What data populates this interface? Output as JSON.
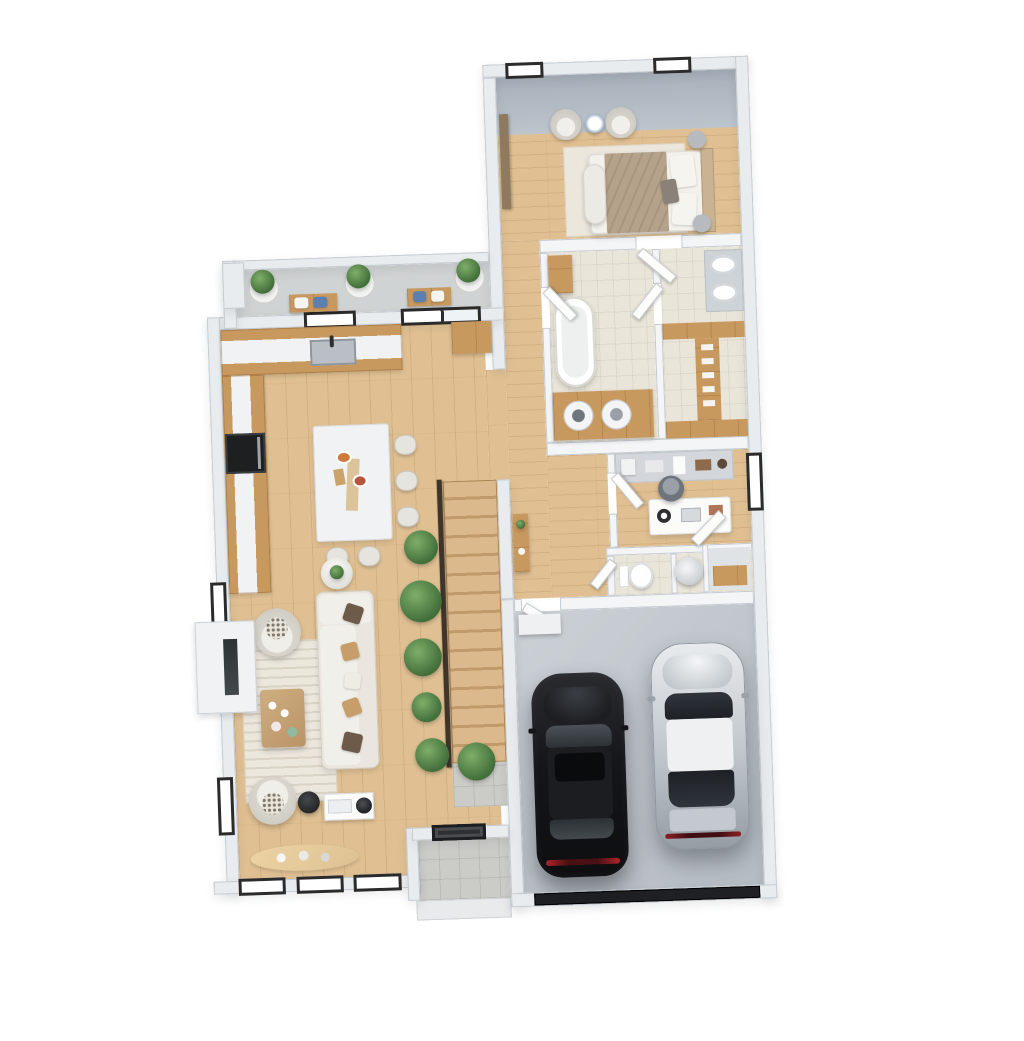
{
  "scene": {
    "kind": "3d-floorplan-render",
    "view": "top-down isometric",
    "background": "#ffffff",
    "storeys_visible": 1,
    "stair_flights": 1
  },
  "palette": {
    "wall": "#e9ecee",
    "iwall": "#f3f5f6",
    "wallEdge": "#c4cbd2",
    "wood": "#e0c093",
    "cab": "#c8995f",
    "marble": "#f1f2f3",
    "tileB": "#eae5d9",
    "tileG": "#cbcbc7",
    "conc": "#d0d3d3",
    "garage1": "#ccd1d6",
    "garage2": "#b5bbc2",
    "gdoor": "#1e2023",
    "sofa": "#eae6df",
    "sofaLine": "#d2cec3",
    "rug": "#ece7dd",
    "blanket": "#b5a28b",
    "stair1": "#dcb98c",
    "stair2": "#c09a6a",
    "rail": "#3f352a",
    "plant1": "#7fae6a",
    "plant2": "#426f3a",
    "pot": "#f2f2f0",
    "frame": "#2b2b2b",
    "glass": "#ffffff",
    "carBlack": "#141619",
    "carSilver": "#c3c9cf",
    "accentBlue": "#5b7fae"
  },
  "legend": {
    "rooms": [
      {
        "name": "master-bedroom",
        "floor": "wood",
        "fixtures": [
          "double-bed",
          "headboard",
          "two-armchairs",
          "round-side-table",
          "area-rug",
          "foot-bench",
          "two-nightstands",
          "wall-shelf",
          "two-windows"
        ]
      },
      {
        "name": "master-bathroom-laundry",
        "floor": "beige-tile",
        "fixtures": [
          "freestanding-tub",
          "laundry-counter",
          "washer",
          "dryer",
          "linen-cabinet"
        ]
      },
      {
        "name": "vanity-dressing",
        "floor": "beige-tile",
        "fixtures": [
          "double-sink-vanity"
        ]
      },
      {
        "name": "walk-in-closet",
        "floor": "beige-tile",
        "fixtures": [
          "wood-wardrobe-shelving",
          "shoe-shelf"
        ]
      },
      {
        "name": "hallway",
        "floor": "wood",
        "fixtures": [
          "console-table",
          "potted-plants"
        ]
      },
      {
        "name": "home-office",
        "floor": "wood",
        "fixtures": [
          "desk",
          "laptop",
          "headphones",
          "office-chair",
          "workbench-shelving",
          "window"
        ]
      },
      {
        "name": "powder-room",
        "floor": "beige-tile",
        "fixtures": [
          "toilet"
        ]
      },
      {
        "name": "utility-nook",
        "floor": "beige-tile",
        "fixtures": [
          "water-heater-cylinder"
        ]
      },
      {
        "name": "mud-closet",
        "floor": "tile",
        "fixtures": [
          "wood-bench-shelf",
          "door"
        ]
      },
      {
        "name": "kitchen",
        "floor": "wood",
        "fixtures": [
          "l-shaped-counter",
          "marble-countertop",
          "sink",
          "faucet",
          "wall-oven",
          "tall-cabinet",
          "window-over-sink",
          "sliding-glass-door"
        ]
      },
      {
        "name": "dining-area",
        "floor": "wood",
        "fixtures": [
          "marble-island-table",
          "five-chairs",
          "table-setting"
        ]
      },
      {
        "name": "living-room",
        "floor": "wood",
        "fixtures": [
          "sectional-sofa",
          "throw-pillows",
          "two-swivel-armchairs",
          "striped-rug",
          "wood-coffee-table",
          "tea-set",
          "fireplace",
          "media-console",
          "speaker",
          "black-pouf",
          "round-side-table",
          "oval-bench",
          "two-side-windows",
          "three-bottom-windows"
        ]
      },
      {
        "name": "patio-deck",
        "floor": "concrete",
        "fixtures": [
          "three-planters",
          "two-cushion-benches",
          "parapet-wall"
        ]
      },
      {
        "name": "staircase",
        "floor": "wood-treads",
        "fixtures": [
          "railing",
          "row-of-plants",
          "landing-tile"
        ]
      },
      {
        "name": "entry-porch",
        "floor": "gray-tile",
        "fixtures": [
          "front-door",
          "step"
        ]
      },
      {
        "name": "garage",
        "floor": "concrete",
        "fixtures": [
          "garage-door",
          "entry-step"
        ]
      }
    ],
    "vehicles": [
      {
        "name": "black-suv",
        "color": "#141619"
      },
      {
        "name": "silver-sedan",
        "color": "#c3c9cf"
      }
    ],
    "counts": {
      "windows": 9,
      "exterior-doors": 3,
      "potted-plants": 12,
      "cars": 2
    }
  }
}
